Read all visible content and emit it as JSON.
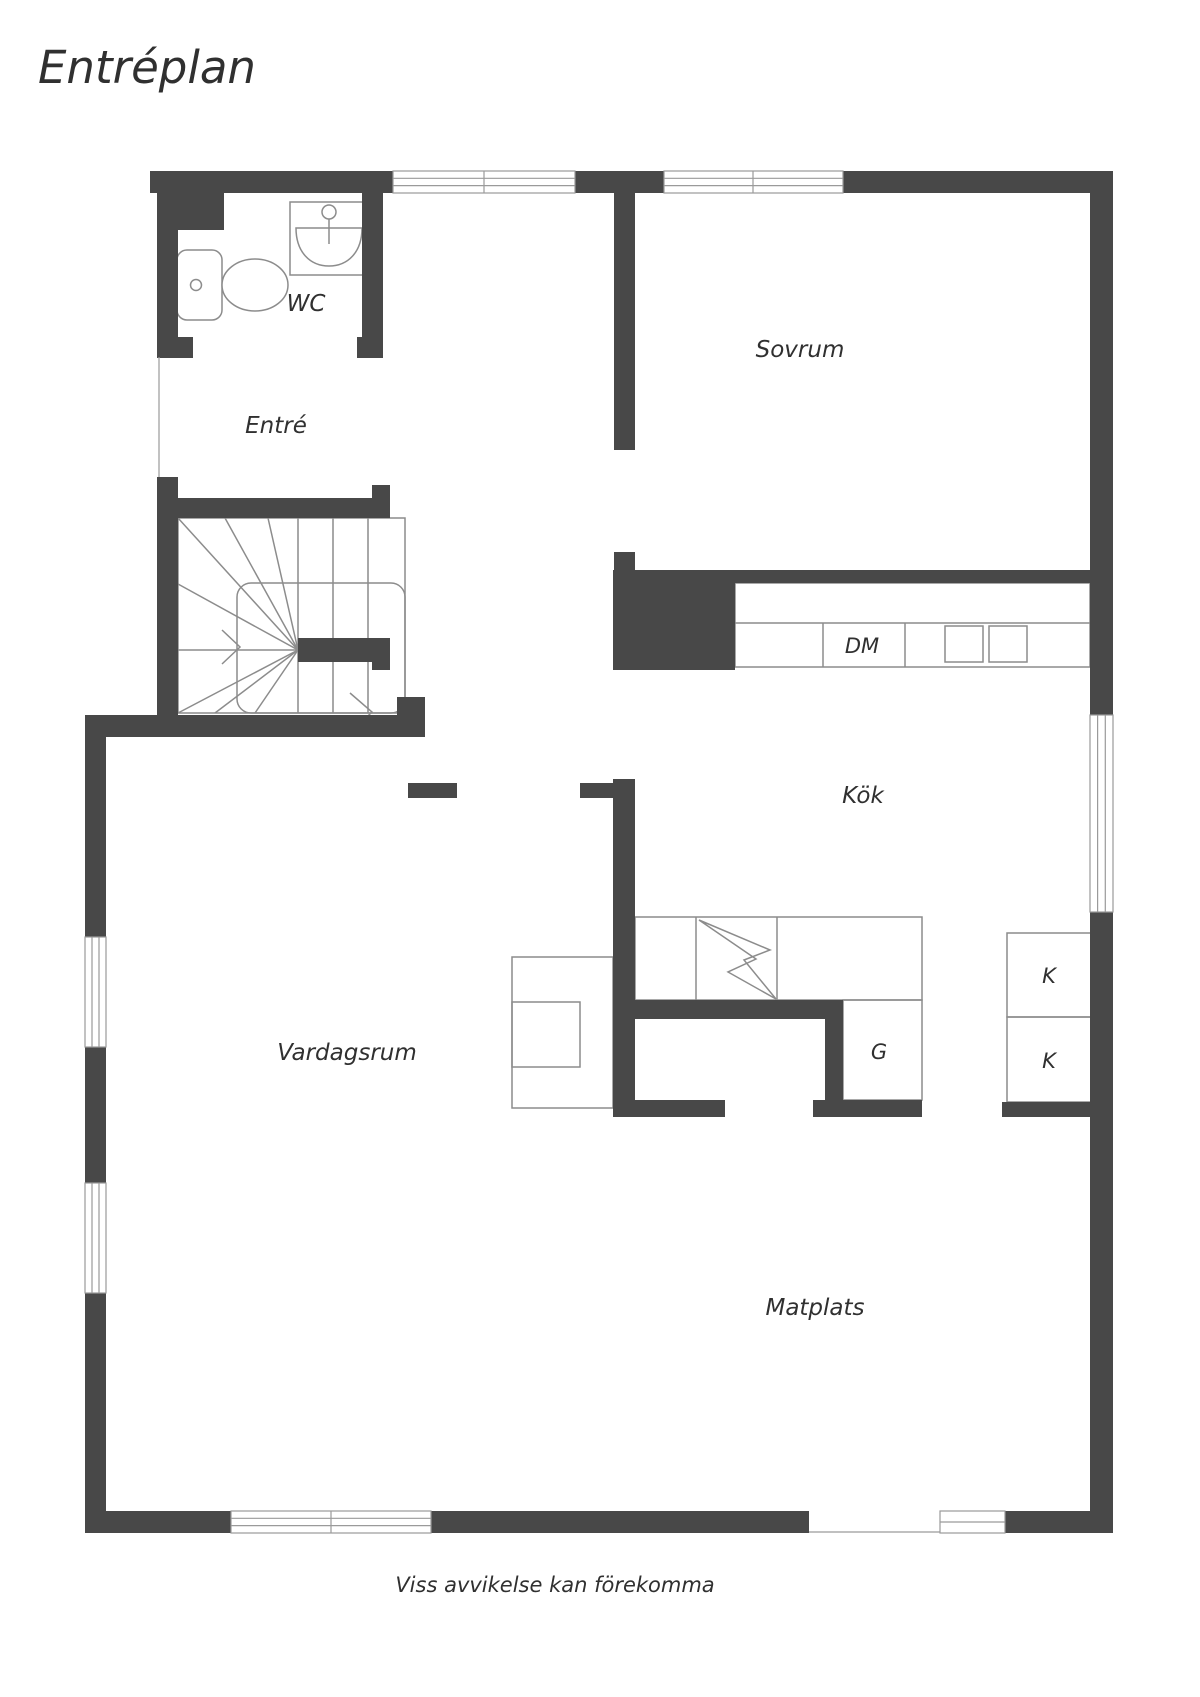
{
  "title": "Entréplan",
  "disclaimer": "Viss avvikelse kan förekomma",
  "rooms": {
    "wc": "WC",
    "entre": "Entré",
    "sovrum": "Sovrum",
    "kok": "Kök",
    "vardagsrum": "Vardagsrum",
    "matplats": "Matplats"
  },
  "appliances": {
    "dm": "DM",
    "g": "G",
    "k1": "K",
    "k2": "K"
  },
  "icons": {
    "toilet": "toilet-icon",
    "sink": "sink-icon",
    "stove": "stove-lightning-icon",
    "stairs": "stairs-icon",
    "windows": "window-marker",
    "door_openings": "door-opening"
  },
  "colors": {
    "wall": "#484848",
    "outline": "#8c8c8c",
    "window_frame": "#9a9a9a",
    "text": "#303030",
    "background": "#ffffff"
  }
}
